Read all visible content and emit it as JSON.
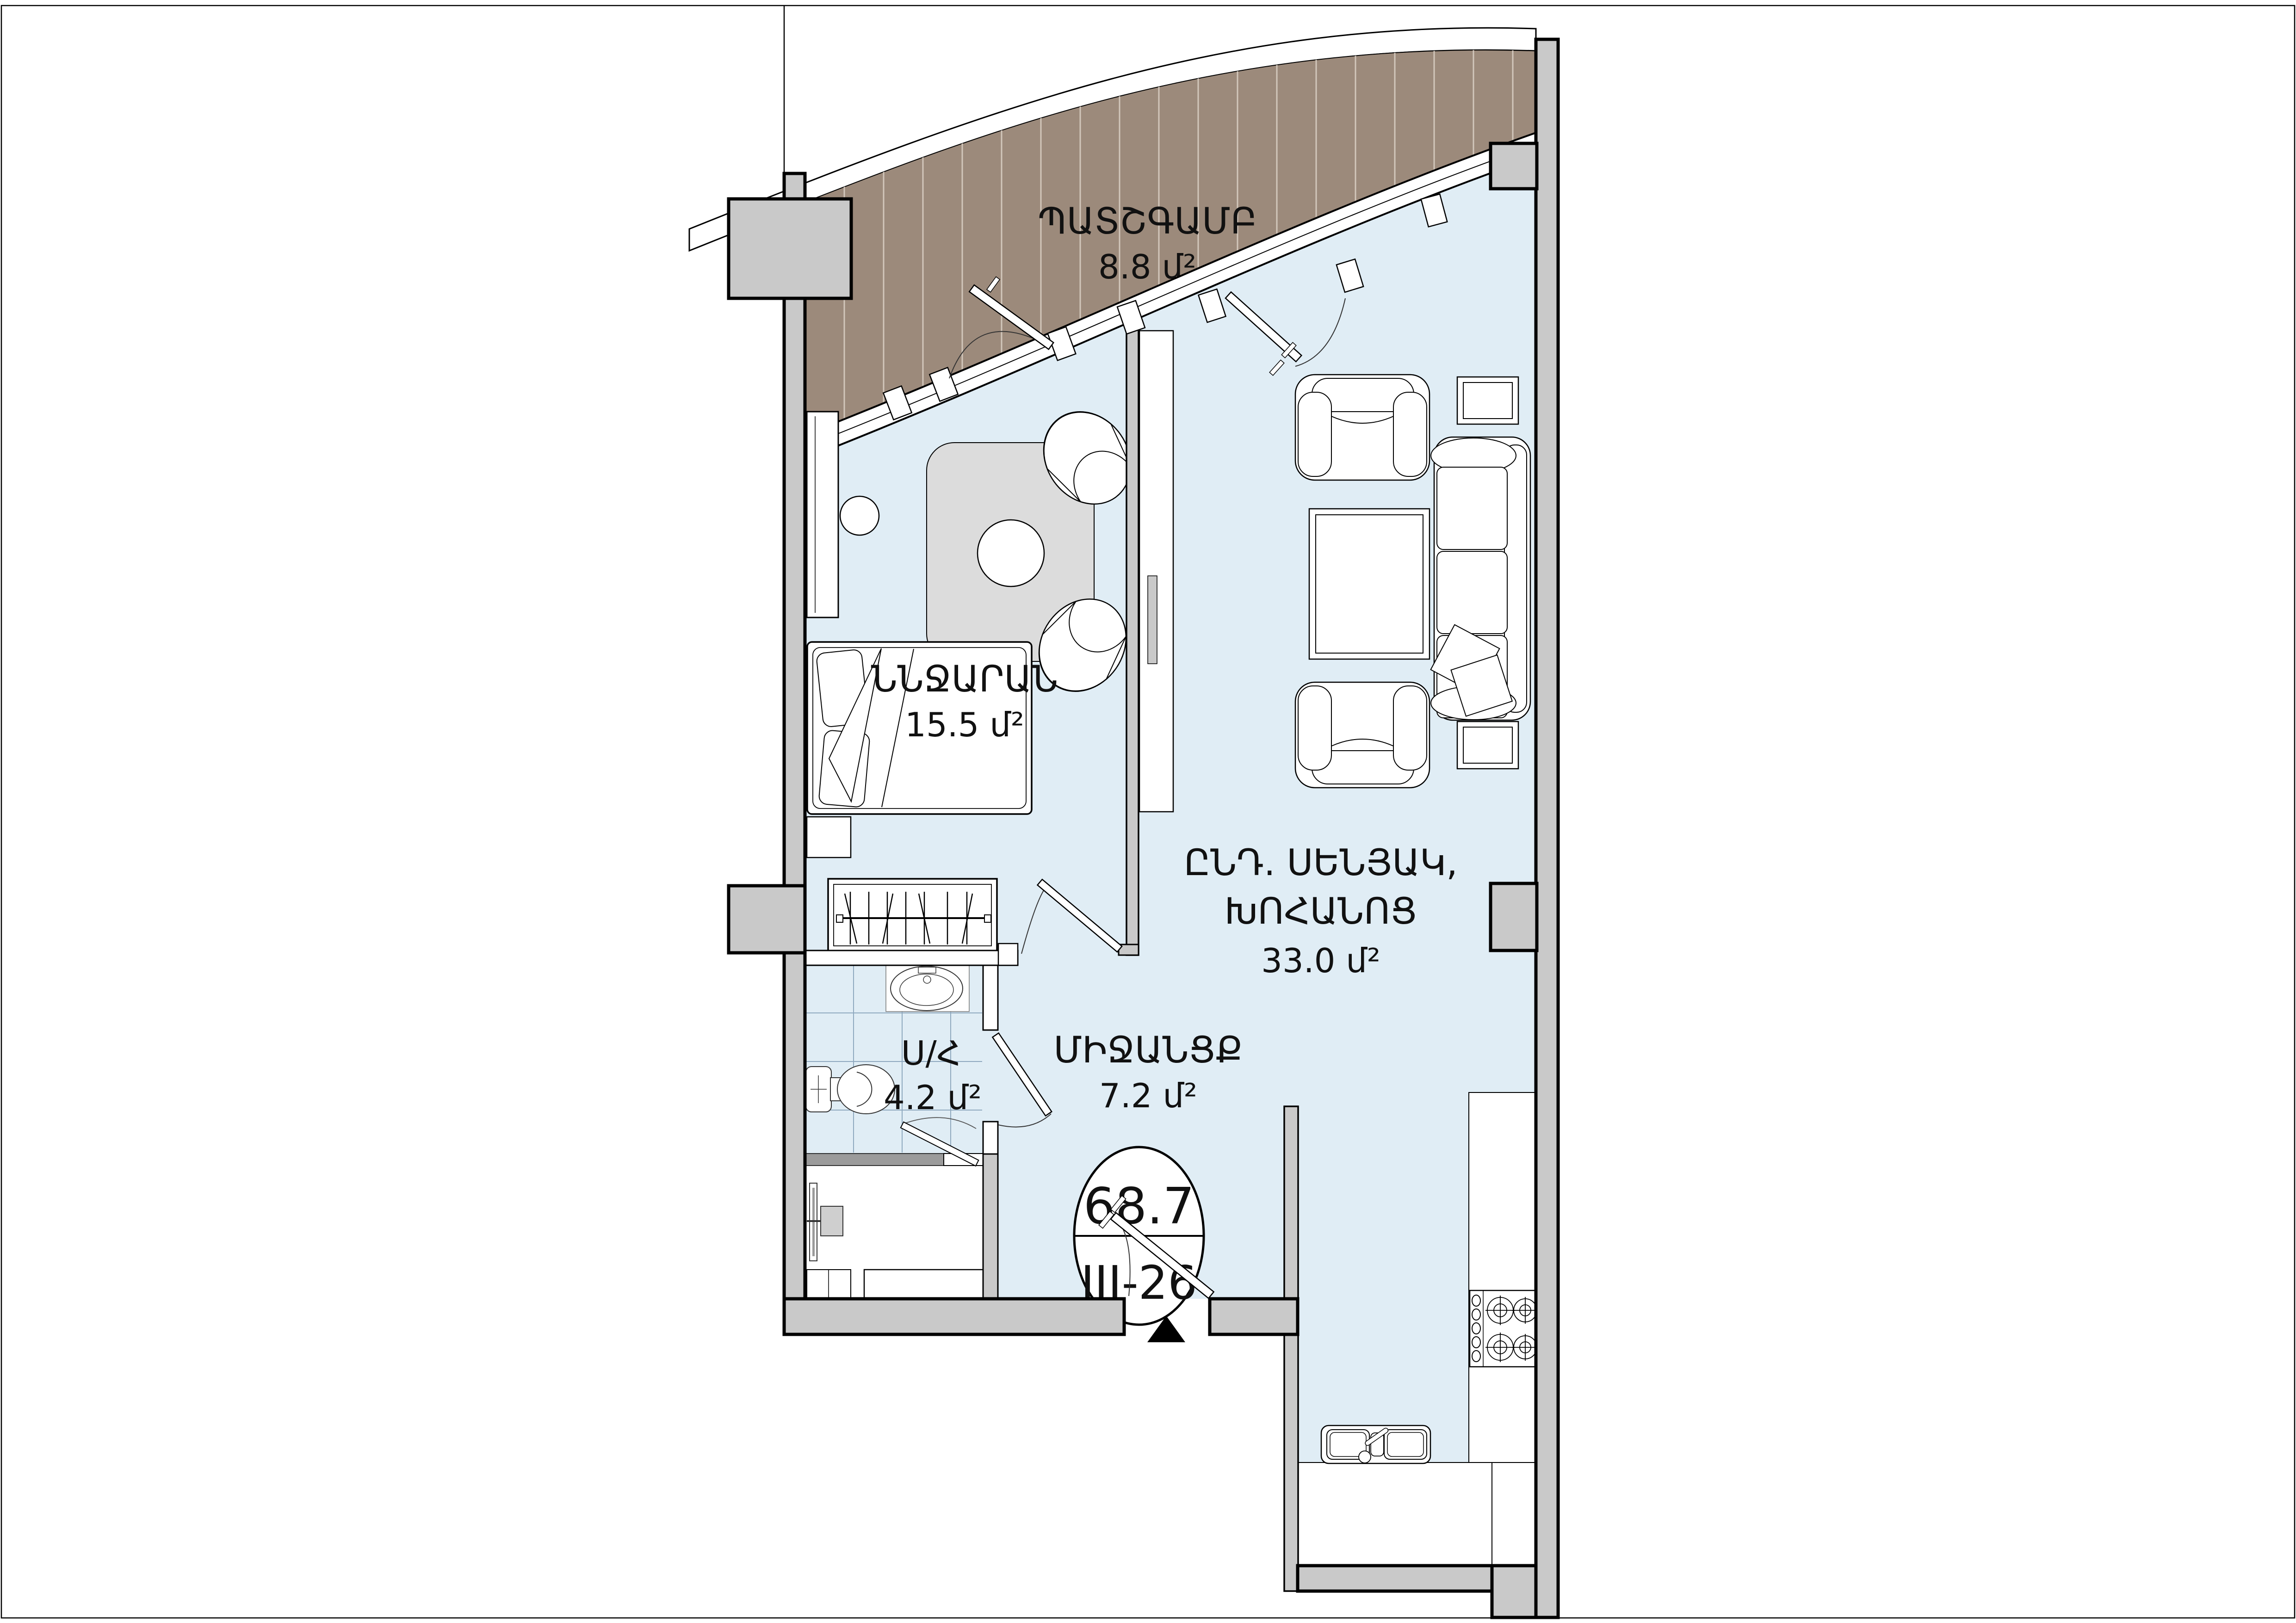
{
  "floor_plan": {
    "rooms": {
      "balcony": {
        "name": "ՊԱՏՇԳԱՄԲ",
        "area": "8.8 մ²"
      },
      "bedroom": {
        "name": "ՆՆՋԱՐԱՆ",
        "area": "15.5 մ²"
      },
      "living_kitchen": {
        "name_line1": "ԸՆԴ. ՍԵՆՅԱԿ,",
        "name_line2": "ԽՈՀԱՆՈՑ",
        "area": "33.0 մ²"
      },
      "bathroom": {
        "name": "Ս/Հ",
        "area": "4.2 մ²"
      },
      "hallway": {
        "name": "ՄԻՋԱՆՑՔ",
        "area": "7.2 մ²"
      }
    },
    "badge": {
      "total_area": "68.7",
      "unit_number": "III-26"
    },
    "colors": {
      "wall_gray": "#c9c9c9",
      "interior_blue": "#e0edf5",
      "balcony_brown": "#9c8a7b",
      "balcony_stripe": "#d2c7bb",
      "tile_line": "#8fa9bf",
      "dark_partition": "#9b9b9b",
      "rug_gray": "#dcdcdc",
      "outline_black": "#000000"
    }
  }
}
